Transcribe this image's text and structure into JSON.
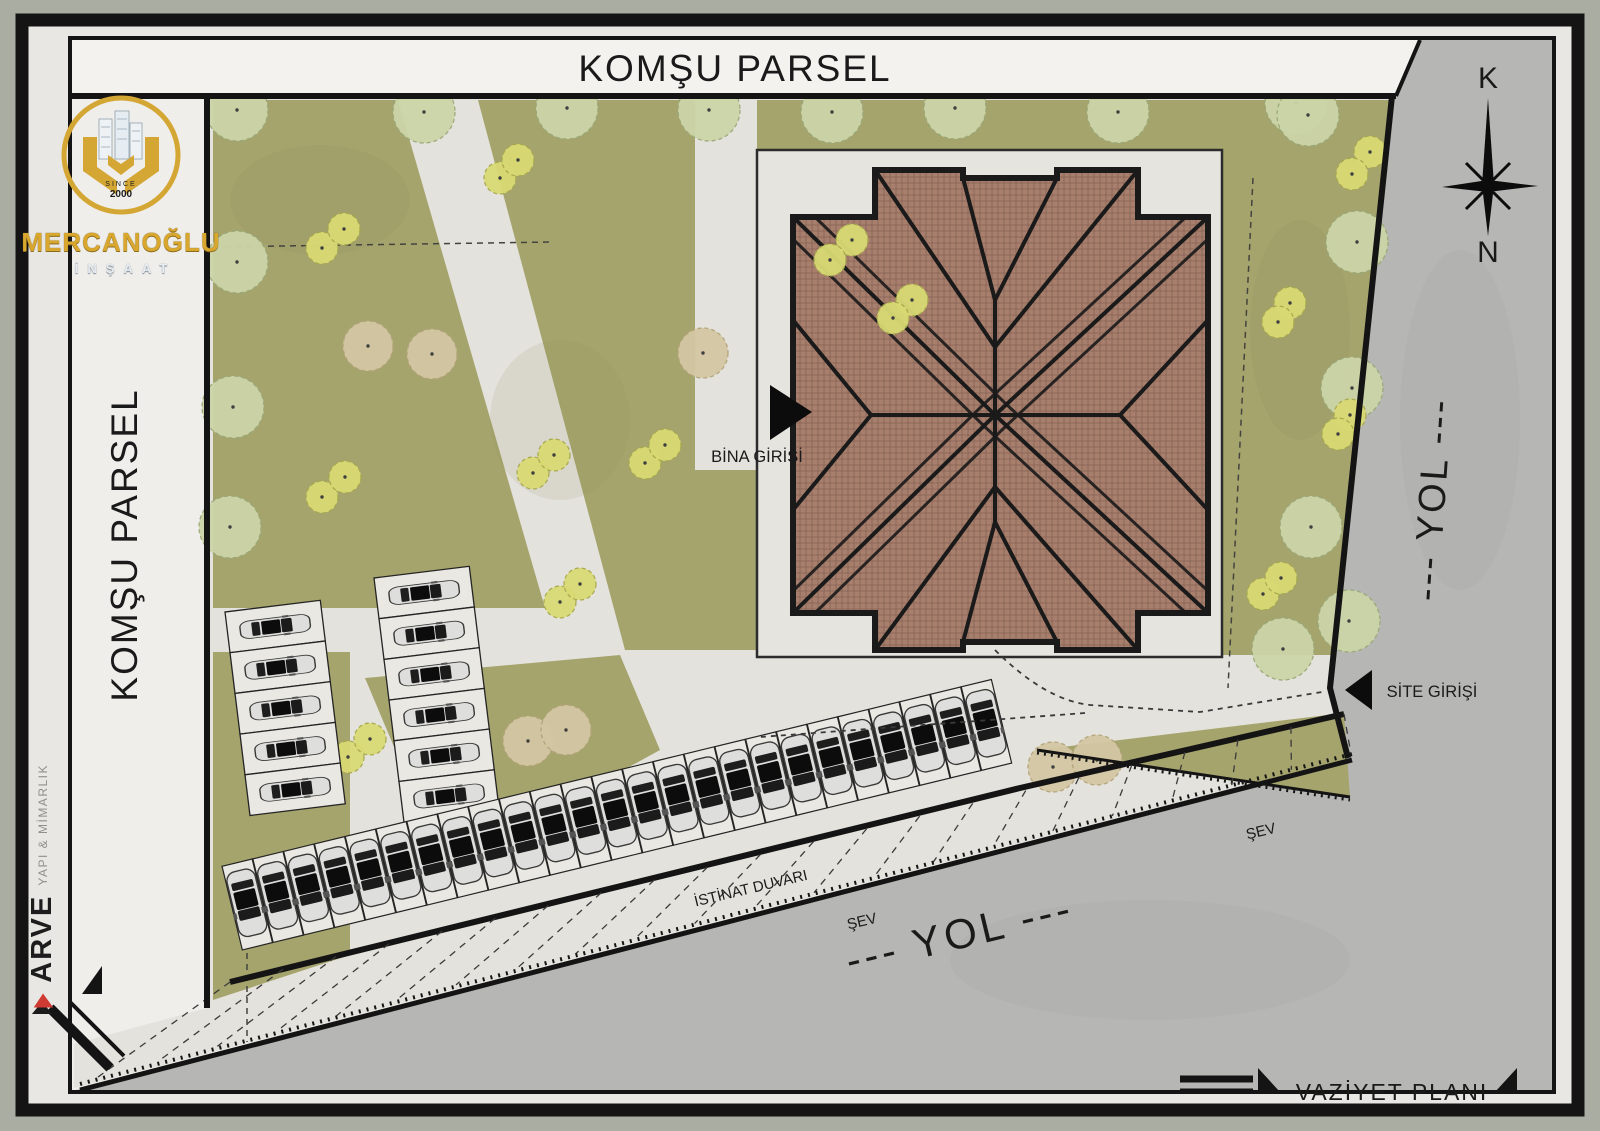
{
  "frame": {
    "plan_label": "VAZİYET PLANI"
  },
  "labels": {
    "top_parcel": "KOMŞU PARSEL",
    "left_parcel": "KOMŞU PARSEL",
    "right_road": "--- YOL ---",
    "bottom_road": "--- YOL ---",
    "building_entrance": "BİNA GİRİŞİ",
    "site_entrance": "SİTE GİRİŞİ",
    "retaining_wall": "İSTİNAT DUVARI",
    "slope_left": "ŞEV",
    "slope_right": "ŞEV",
    "compass_top": "K",
    "compass_bottom": "N"
  },
  "logo": {
    "since_top": "SINCE",
    "since_bottom": "2000",
    "company": "MERCANOĞLU",
    "subtitle": "İNŞAAT"
  },
  "studio": {
    "brand": "ARVE",
    "tagline": "YAPI & MİMARLIK"
  },
  "colors": {
    "sheet_bg": "#a9ada2",
    "margin": "#e8e7e3",
    "frame": "#141414",
    "paper": "#efeeea",
    "grass": "#a5a46d",
    "path": "#e4e2dc",
    "plaza": "#e6e4de",
    "road": "#b6b6b4",
    "roof": "#a87f6d",
    "roof_hatch": "#7a594b",
    "roof_line": "#1a1a1a",
    "tree_pale": "#ccd5a8",
    "tree_pale_edge": "#9aa878",
    "tree_shrub": "#d9da74",
    "tree_shrub_edge": "#a8a84e",
    "tree_tan": "#d4c7a4",
    "tree_tan_edge": "#b3a379",
    "car_body": "#dededc",
    "car_dark": "#111111",
    "stall": "#eae8e2",
    "gold": "#d4a633",
    "silver": "#dde4ea",
    "red": "#cf3a32"
  },
  "plan": {
    "trees": {
      "pale_r": 31,
      "shrub_r": 16,
      "tan_r": 25,
      "pale": [
        [
          237,
          110
        ],
        [
          424,
          112
        ],
        [
          567,
          108
        ],
        [
          709,
          110
        ],
        [
          832,
          112
        ],
        [
          955,
          108
        ],
        [
          1118,
          112
        ],
        [
          1296,
          103
        ],
        [
          237,
          262
        ],
        [
          233,
          407
        ],
        [
          230,
          527
        ],
        [
          1308,
          115
        ],
        [
          1357,
          242
        ],
        [
          1352,
          388
        ],
        [
          1311,
          527
        ],
        [
          1349,
          621
        ],
        [
          1283,
          649
        ]
      ],
      "shrub": [
        [
          322,
          248
        ],
        [
          344,
          229
        ],
        [
          500,
          178
        ],
        [
          518,
          160
        ],
        [
          852,
          240
        ],
        [
          830,
          260
        ],
        [
          1370,
          152
        ],
        [
          1352,
          174
        ],
        [
          1290,
          303
        ],
        [
          1278,
          322
        ],
        [
          1350,
          415
        ],
        [
          1338,
          434
        ],
        [
          322,
          497
        ],
        [
          345,
          477
        ],
        [
          533,
          473
        ],
        [
          554,
          455
        ],
        [
          645,
          463
        ],
        [
          665,
          445
        ],
        [
          560,
          602
        ],
        [
          580,
          584
        ],
        [
          1263,
          594
        ],
        [
          1281,
          578
        ],
        [
          912,
          300
        ],
        [
          893,
          318
        ],
        [
          348,
          757
        ],
        [
          370,
          739
        ]
      ],
      "tan": [
        [
          368,
          346
        ],
        [
          432,
          354
        ],
        [
          703,
          353
        ],
        [
          528,
          741
        ],
        [
          566,
          730
        ],
        [
          1053,
          767
        ],
        [
          1097,
          760
        ]
      ]
    },
    "parking": {
      "left_columns": [
        {
          "x": 225,
          "y": 612,
          "angle": -7,
          "stall_w": 96,
          "stall_h": 41,
          "count": 5
        },
        {
          "x": 374,
          "y": 578,
          "angle": -7,
          "stall_w": 96,
          "stall_h": 41,
          "count": 6
        }
      ],
      "bottom_row": {
        "x1": 242,
        "y1": 950,
        "x2": 1012,
        "y2": 763,
        "count": 25,
        "stall_w": 31,
        "stall_depth": 86
      }
    },
    "slope_hatch": {
      "count": 22
    }
  }
}
